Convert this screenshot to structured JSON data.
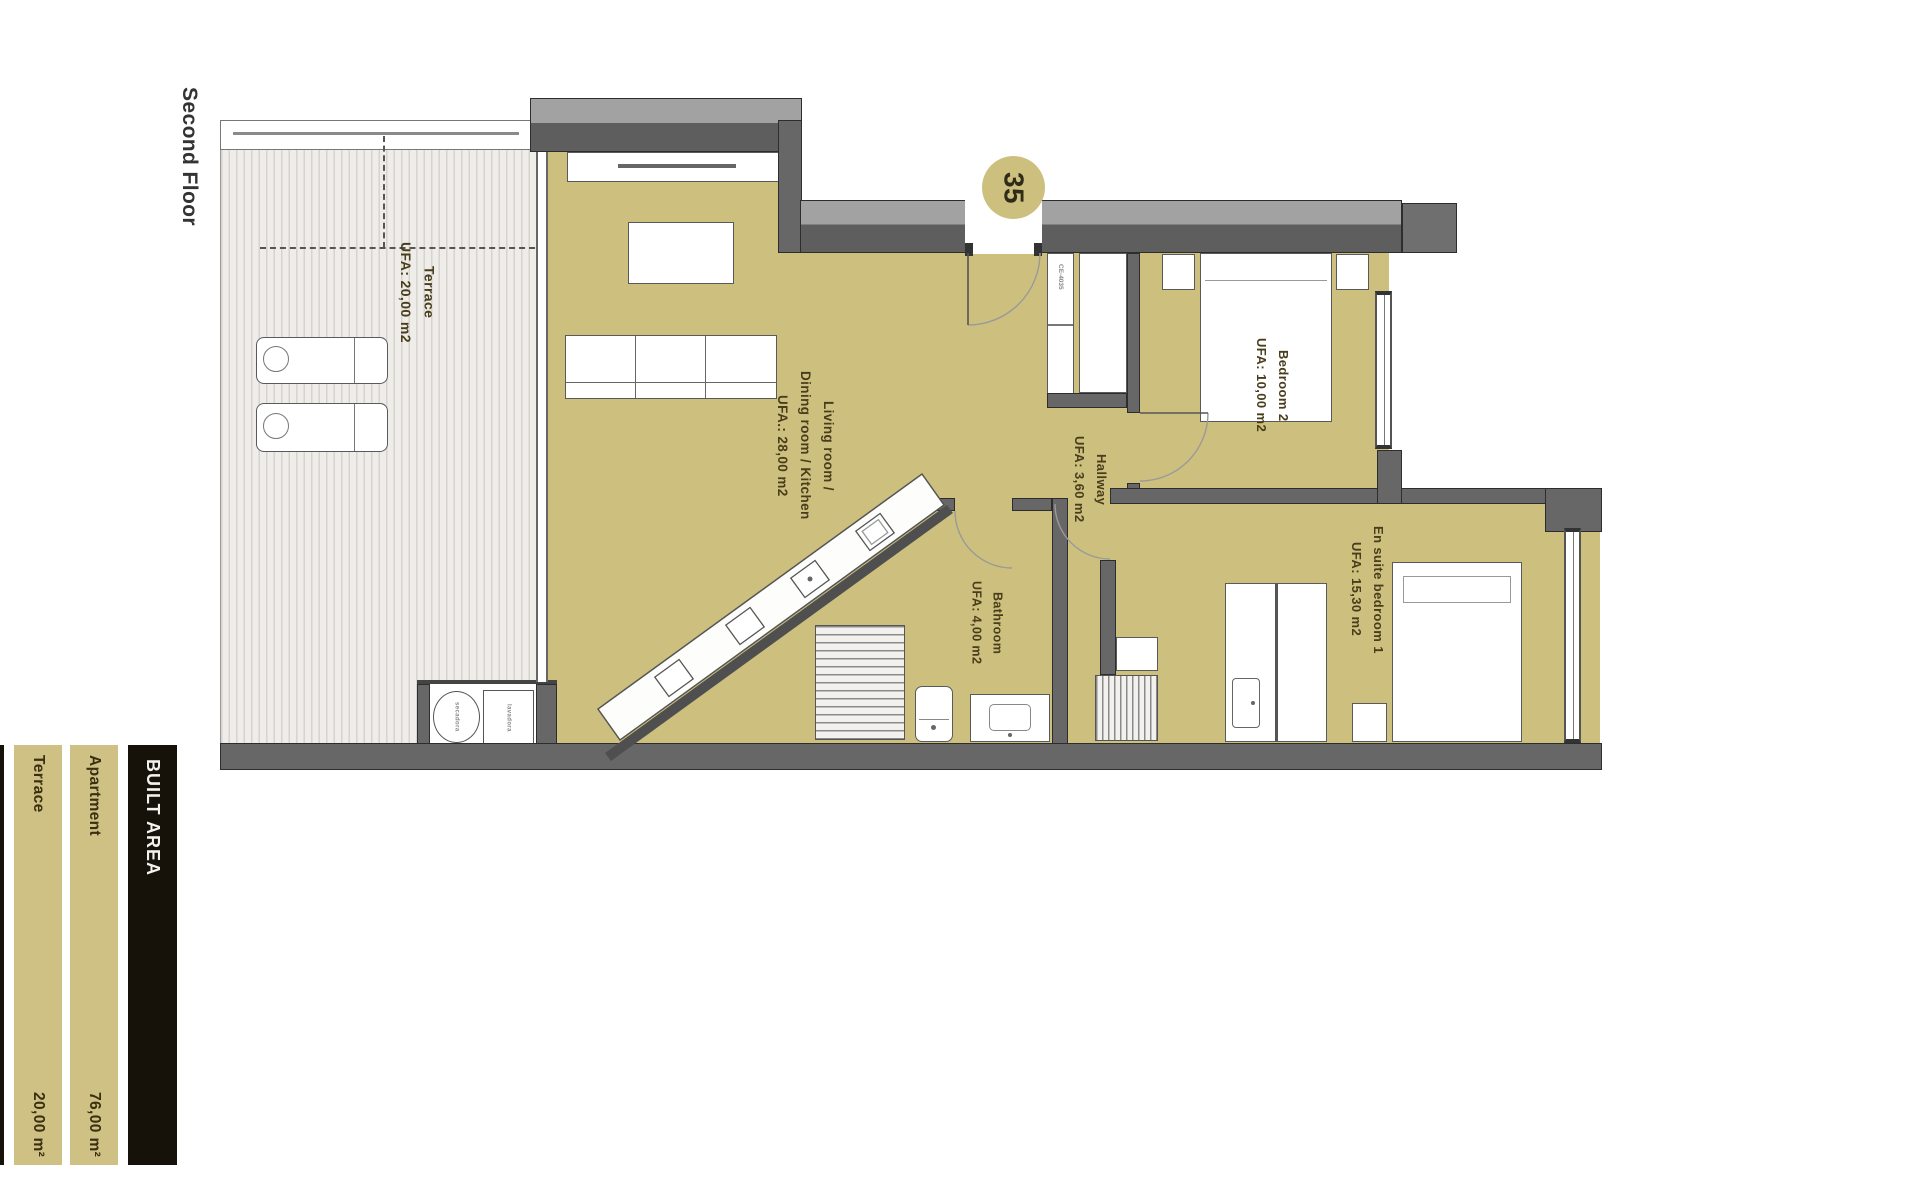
{
  "page": {
    "floor_label": "Second Floor",
    "unit_number": "35"
  },
  "rooms": {
    "terrace": {
      "name": "Terrace",
      "area": "UFA: 20,00 m2"
    },
    "living": {
      "name": "Living room /",
      "name_line2": "Dining room / Kitchen",
      "area": "UFA.: 28,00 m2"
    },
    "bedroom2": {
      "name": "Bedroom 2",
      "area": "UFA: 10,00 m2"
    },
    "hallway": {
      "name": "Hallway",
      "area": "UFA: 3,60 m2"
    },
    "bathroom": {
      "name": "Bathroom",
      "area": "UFA: 4,00 m2"
    },
    "ensuite": {
      "name": "En suite bedroom 1",
      "area": "UFA: 15,30 m2"
    }
  },
  "fixtures": {
    "closet_code": "CE-4035",
    "dryer": "secadora",
    "washer": "lavadora"
  },
  "area_table": {
    "title": "BUILT AREA",
    "rows": [
      {
        "label": "Apartment",
        "value": "76,00 m²"
      },
      {
        "label": "Terrace",
        "value": "20,00 m²"
      }
    ]
  },
  "colors": {
    "floor_tan": "#cdc07e",
    "wall_gray": "#676767",
    "table_black": "#161209",
    "bar_tan": "#cfc183"
  }
}
